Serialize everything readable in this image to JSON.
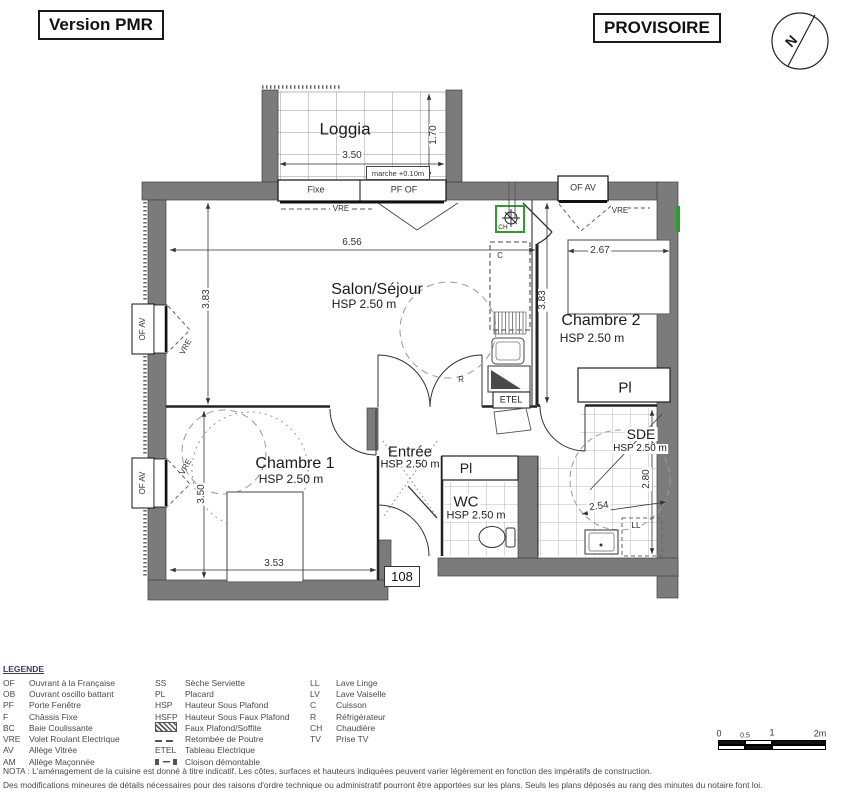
{
  "header": {
    "version": "Version PMR",
    "status": "PROVISOIRE",
    "compass_n": "N"
  },
  "rooms": {
    "loggia": {
      "name": "Loggia"
    },
    "salon": {
      "name": "Salon/Séjour",
      "hsp": "HSP 2.50 m"
    },
    "chambre2": {
      "name": "Chambre 2",
      "hsp": "HSP 2.50 m"
    },
    "chambre1": {
      "name": "Chambre 1",
      "hsp": "HSP 2.50 m"
    },
    "entree": {
      "name": "Entrée",
      "hsp": "HSP 2.50 m"
    },
    "wc": {
      "name": "WC",
      "hsp": "HSP 2.50 m"
    },
    "sde": {
      "name": "SDE",
      "hsp": "HSP 2.50 m"
    }
  },
  "dims": {
    "loggia_w": "3.50",
    "loggia_d": "1.70",
    "marche": "marche +0.10m",
    "salon_w": "6.56",
    "salon_h": "3.83",
    "kitchen_h": "3.83",
    "chambre2_w": "2.67",
    "chambre1_h": "3.50",
    "chambre1_w": "3.53",
    "sde_h": "2.80",
    "sde_w": "2.54"
  },
  "tags": {
    "fixe": "Fixe",
    "pf_of": "PF OF",
    "of_av": "OF AV",
    "vre": "VRE",
    "pl": "Pl",
    "ll": "LL",
    "c": "C",
    "r": "R",
    "etel": "ETEL",
    "ch": "CH",
    "unit": "108"
  },
  "legend": {
    "title": "LEGENDE",
    "col1": [
      {
        "abbr": "OF",
        "label": "Ouvrant à la Française"
      },
      {
        "abbr": "OB",
        "label": "Ouvrant oscillo battant"
      },
      {
        "abbr": "PF",
        "label": "Porte Fenêtre"
      },
      {
        "abbr": "F",
        "label": "Châssis Fixe"
      },
      {
        "abbr": "BC",
        "label": "Baie Coulissante"
      },
      {
        "abbr": "VRE",
        "label": "Volet Roulant Electrique"
      },
      {
        "abbr": "AV",
        "label": "Allège Vitrée"
      },
      {
        "abbr": "AM",
        "label": "Allège Maçonnée"
      }
    ],
    "col2": [
      {
        "abbr": "SS",
        "label": "Sèche Serviette"
      },
      {
        "abbr": "PL",
        "label": "Placard"
      },
      {
        "abbr": "HSP",
        "label": "Hauteur Sous Plafond"
      },
      {
        "abbr": "HSFP",
        "label": "Hauteur Sous Faux Plafond"
      },
      {
        "icon": "hatch",
        "label": "Faux Plafond/Soffite"
      },
      {
        "icon": "beam",
        "label": "Retombée de Poutre"
      },
      {
        "abbr": "ETEL",
        "label": "Tableau Electrique"
      },
      {
        "icon": "partition",
        "label": "Cloison démontable"
      }
    ],
    "col3": [
      {
        "abbr": "LL",
        "label": "Lave Linge"
      },
      {
        "abbr": "LV",
        "label": "Lave Vaiselle"
      },
      {
        "abbr": "C",
        "label": "Cuisson"
      },
      {
        "abbr": "R",
        "label": "Réfrigérateur"
      },
      {
        "abbr": "CH",
        "label": "Chaudière"
      },
      {
        "abbr": "TV",
        "label": "Prise TV"
      }
    ]
  },
  "scale": {
    "t0": "0",
    "t05": "0.5",
    "t1": "1",
    "t2": "2m"
  },
  "nota": {
    "line1": "NOTA : L'aménagement de la cuisine est donné à titre indicatif. Les côtes, surfaces et hauteurs indiquées peuvent varier légèrement en fonction des impératifs de construction.",
    "line2": "Des modifications mineures de détails nécessaires pour des raisons d'ordre technique ou administratif pourront être apportées sur les plans. Seuls les plans déposés au rang des minutes du notaire font loi."
  },
  "colors": {
    "wall": "#7b7b7b",
    "accent_green": "#2ca02c"
  }
}
